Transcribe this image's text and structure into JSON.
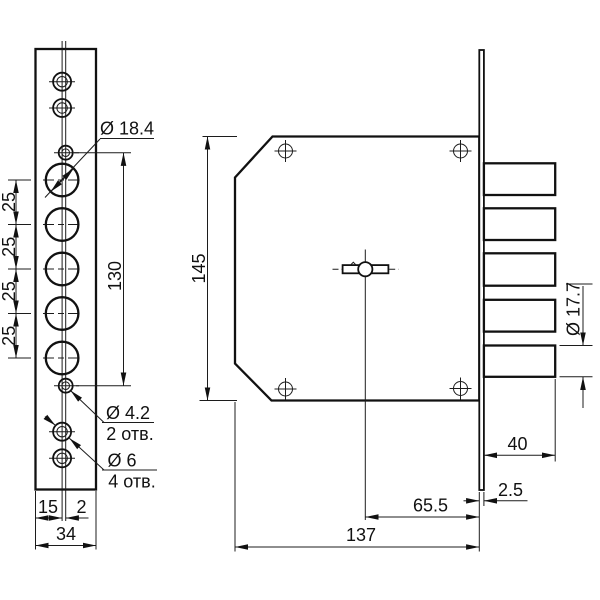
{
  "drawing": {
    "kind": "lock-technical-drawing",
    "view_left": {
      "pitch_labels": [
        "25",
        "25",
        "25",
        "25"
      ],
      "span_130": "130",
      "dia_big": "Ø 18.4",
      "dia_small": "Ø 4.2",
      "dia_small_count": "2 отв.",
      "dia_screw": "Ø 6",
      "dia_screw_count": "4 отв.",
      "dim_15": "15",
      "dim_2": "2",
      "dim_34": "34"
    },
    "view_right": {
      "dim_145": "145",
      "dim_40": "40",
      "dim_bolt_dia": "Ø 17.7",
      "dim_2_5": "2.5",
      "dim_65_5": "65.5",
      "dim_137": "137"
    },
    "colors": {
      "line": "#111111",
      "background": "#ffffff"
    }
  }
}
